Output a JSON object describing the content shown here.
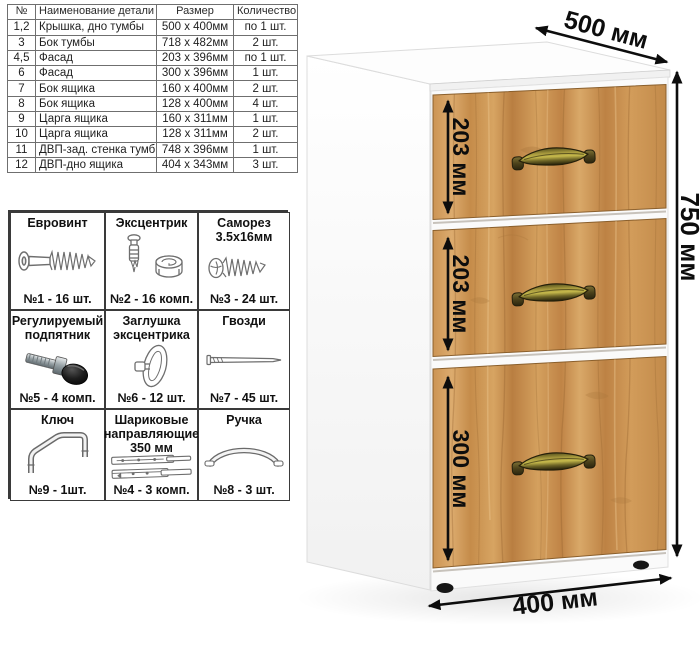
{
  "parts_table": {
    "headers": [
      "№",
      "Наименование детали",
      "Размер",
      "Количество"
    ],
    "rows": [
      {
        "num": "1,2",
        "name": "Крышка, дно тумбы",
        "size": "500 х 400мм",
        "qty": "по 1 шт."
      },
      {
        "num": "3",
        "name": "Бок тумбы",
        "size": "718 х 482мм",
        "qty": "2 шт."
      },
      {
        "num": "4,5",
        "name": "Фасад",
        "size": "203 х 396мм",
        "qty": "по 1 шт."
      },
      {
        "num": "6",
        "name": "Фасад",
        "size": "300 х 396мм",
        "qty": "1 шт."
      },
      {
        "num": "7",
        "name": "Бок ящика",
        "size": "160 х 400мм",
        "qty": "2 шт."
      },
      {
        "num": "8",
        "name": "Бок ящика",
        "size": "128 х 400мм",
        "qty": "4 шт."
      },
      {
        "num": "9",
        "name": "Царга ящика",
        "size": "160 х 311мм",
        "qty": "1 шт."
      },
      {
        "num": "10",
        "name": "Царга ящика",
        "size": "128 х 311мм",
        "qty": "2 шт."
      },
      {
        "num": "11",
        "name": "ДВП-зад. стенка тумбы",
        "size": "748 х 396мм",
        "qty": "1 шт."
      },
      {
        "num": "12",
        "name": "ДВП-дно ящика",
        "size": "404 х 343мм",
        "qty": "3 шт."
      }
    ]
  },
  "hardware": {
    "cells": [
      {
        "icon": "euro-screw-icon",
        "line1": "Евровинт",
        "line2": "",
        "line3": "",
        "caption": "№1 - 16 шт."
      },
      {
        "icon": "eccentric-cam-icon",
        "line1": "Эксцентрик",
        "line2": "",
        "line3": "",
        "caption": "№2 - 16 комп."
      },
      {
        "icon": "self-tap-screw-icon",
        "line1": "Саморез",
        "line2": "3.5х16мм",
        "line3": "",
        "caption": "№3 - 24 шт."
      },
      {
        "icon": "adjustable-foot-icon",
        "line1": "Регулируемый",
        "line2": "подпятник",
        "line3": "",
        "caption": "№5 - 4 комп."
      },
      {
        "icon": "cam-cover-icon",
        "line1": "Заглушка",
        "line2": "эксцентрика",
        "line3": "",
        "caption": "№6 - 12 шт."
      },
      {
        "icon": "nail-icon",
        "line1": "Гвозди",
        "line2": "",
        "line3": "",
        "caption": "№7 - 45 шт."
      },
      {
        "icon": "hex-key-icon",
        "line1": "Ключ",
        "line2": "",
        "line3": "",
        "caption": "№9 - 1шт."
      },
      {
        "icon": "ball-slides-icon",
        "line1": "Шариковые",
        "line2": "направляющие",
        "line3": "350 мм",
        "caption": "№4 - 3 комп."
      },
      {
        "icon": "handle-icon",
        "line1": "Ручка",
        "line2": "",
        "line3": "",
        "caption": "№8 - 3 шт."
      }
    ]
  },
  "cabinet": {
    "dims": {
      "top_depth": "500 мм",
      "height": "750 мм",
      "bottom_width": "400 мм",
      "drawer1": "203 мм",
      "drawer2": "203 мм",
      "drawer3": "300 мм"
    },
    "colors": {
      "wood_light": "#dcab6e",
      "wood_mid": "#c68f4e",
      "wood_dark": "#9a6a33",
      "handle_brass": "#c5b84b",
      "handle_shadow": "#26200a",
      "dimension_black": "#0d0d0d",
      "carcass_white": "#fbfbfb"
    }
  }
}
